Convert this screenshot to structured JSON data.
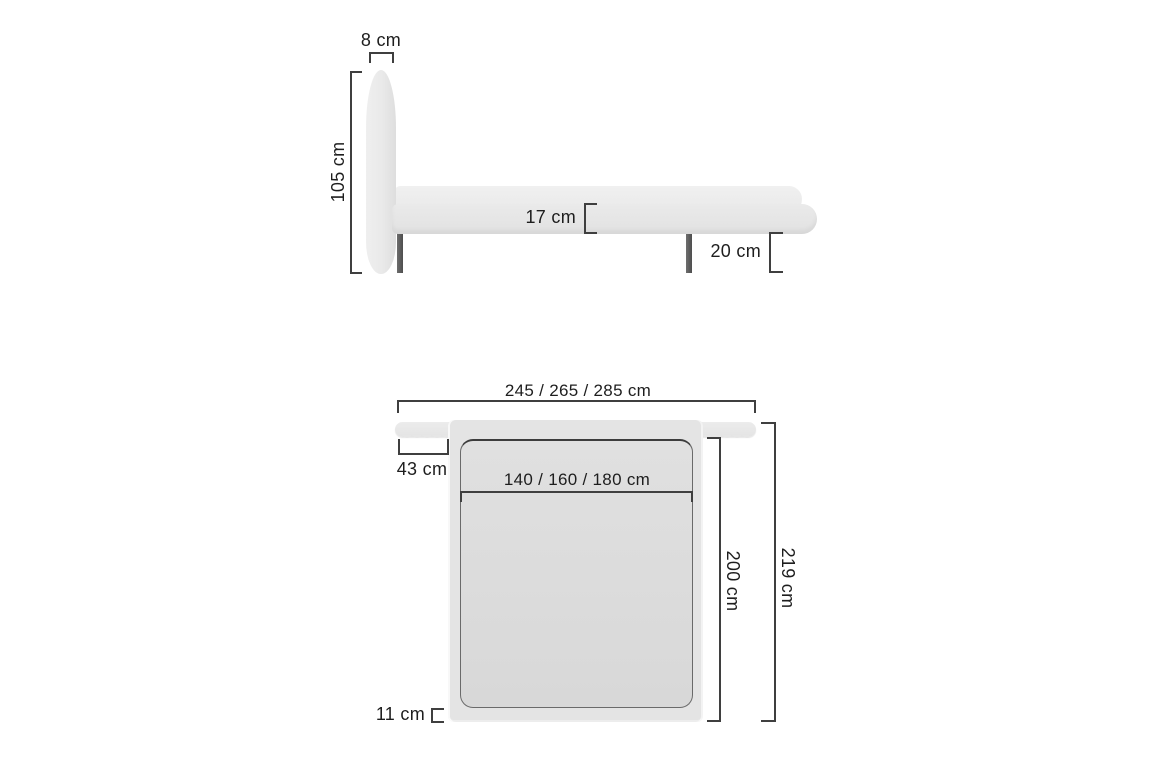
{
  "side_view": {
    "headboard_thickness": "8 cm",
    "headboard_height": "105 cm",
    "frame_height": "17 cm",
    "leg_height": "20 cm"
  },
  "top_view": {
    "total_width": "245 / 265 / 285 cm",
    "headboard_side_overhang": "43 cm",
    "mattress_width": "140 / 160 / 180 cm",
    "mattress_length": "200 cm",
    "total_length": "219 cm",
    "foot_rail_width": "11 cm"
  },
  "colors": {
    "background": "#ffffff",
    "dimension_line": "#3f3f3f",
    "text": "#1e1e1e",
    "upholstery_light": "#e8e8e8",
    "mattress_fill": "#dcdcdc",
    "leg_fill": "#5a5a5a"
  }
}
